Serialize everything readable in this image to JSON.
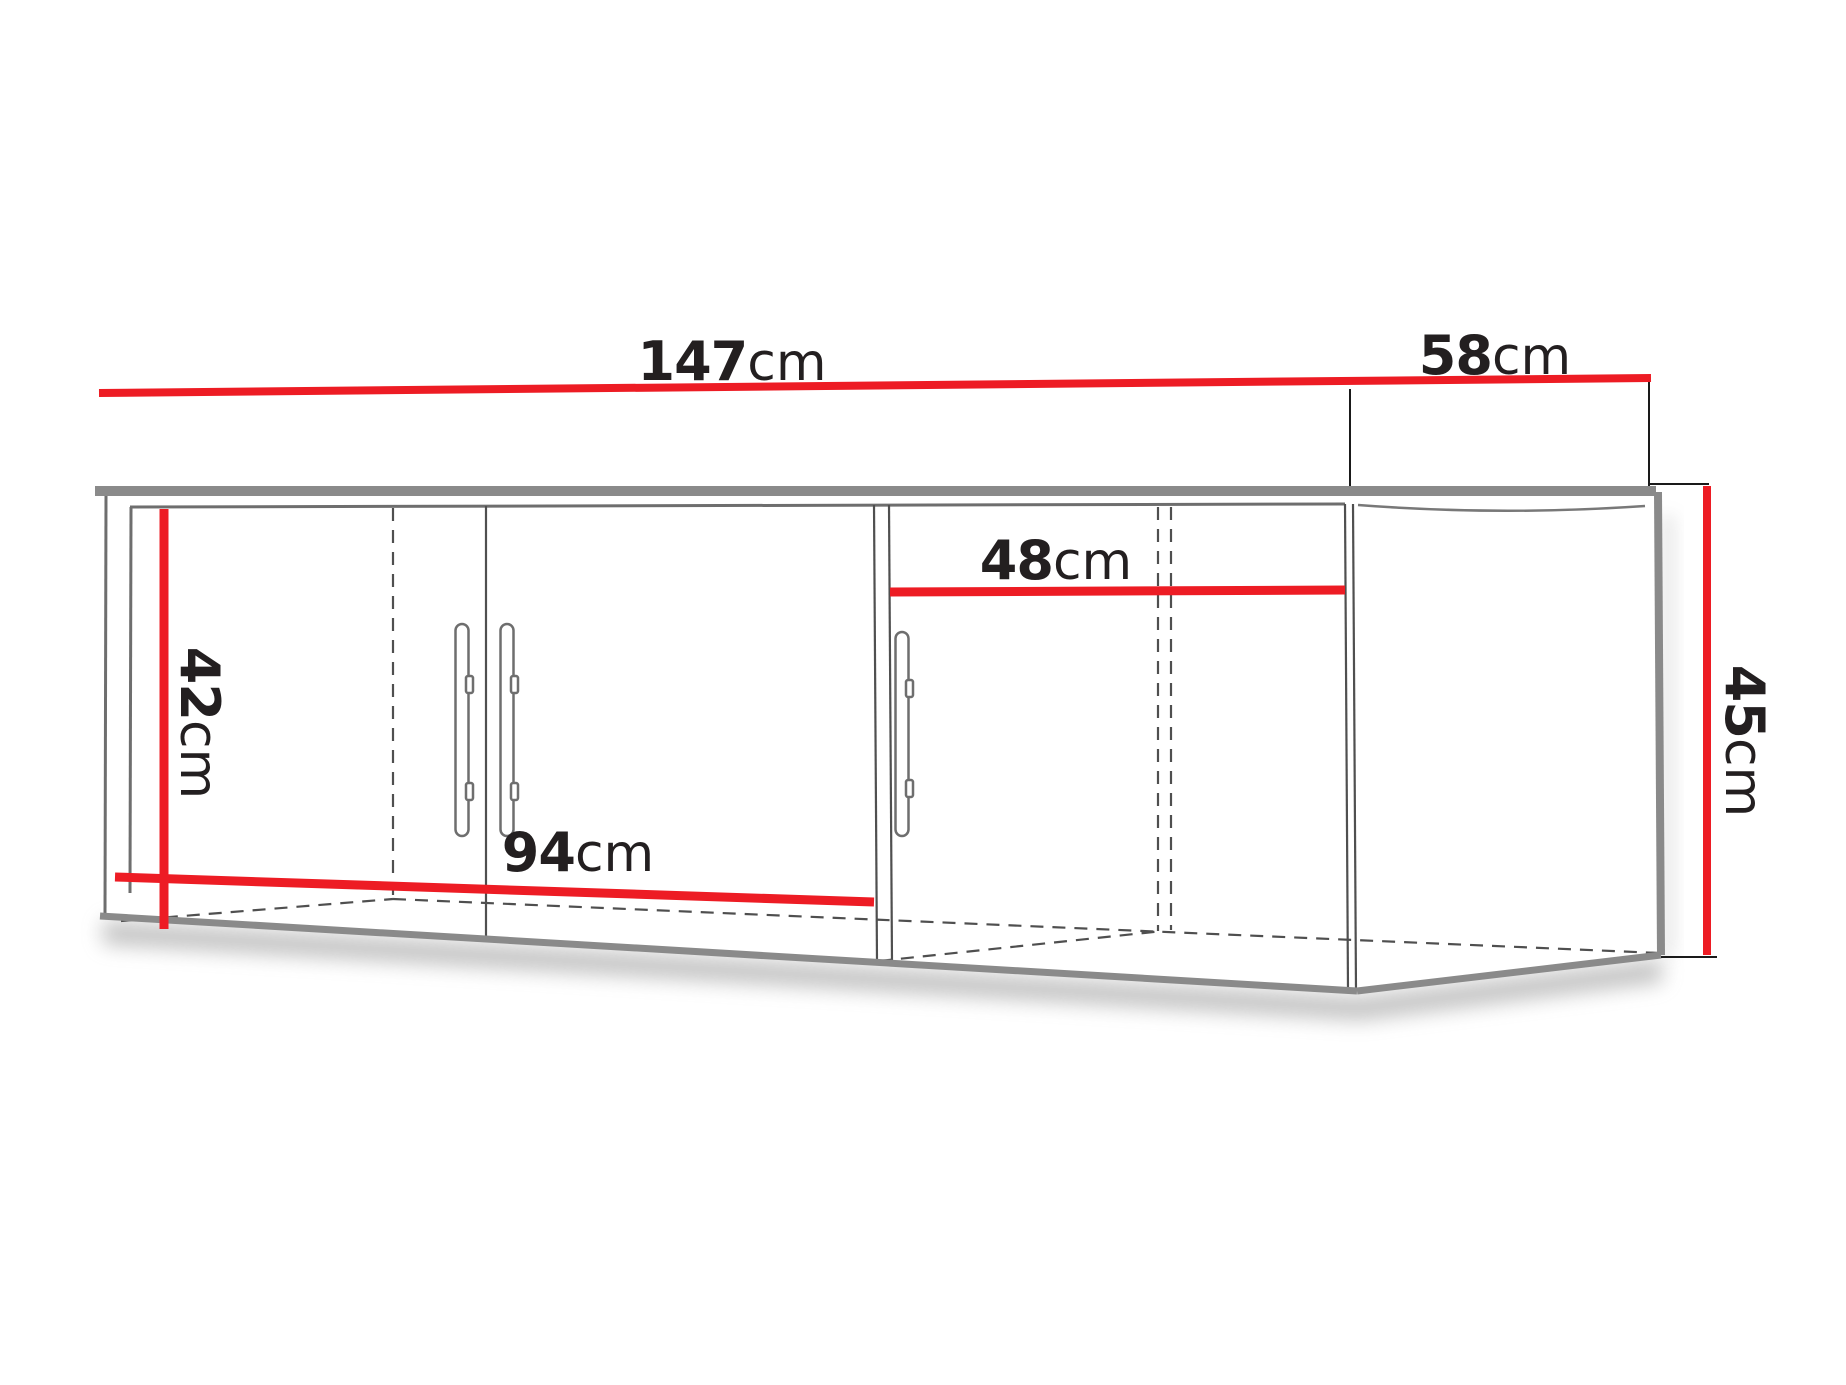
{
  "diagram": {
    "title": "wall-cabinet-dimension-diagram",
    "colors": {
      "dimension_line": "#ed1c24",
      "text": "#231f20",
      "cabinet_edge_thick": "#8a8a8a",
      "cabinet_edge_thin": "#4f4f4f",
      "hidden_edge_dashed": "#4f4f4f",
      "background": "#ffffff"
    }
  },
  "dimensions": {
    "width_total": {
      "value": "147",
      "unit": "cm"
    },
    "depth": {
      "value": "58",
      "unit": "cm"
    },
    "height_right": {
      "value": "45",
      "unit": "cm"
    },
    "interior_height_left": {
      "value": "42",
      "unit": "cm"
    },
    "left_doors_width": {
      "value": "94",
      "unit": "cm"
    },
    "right_door_width": {
      "value": "48",
      "unit": "cm"
    }
  }
}
